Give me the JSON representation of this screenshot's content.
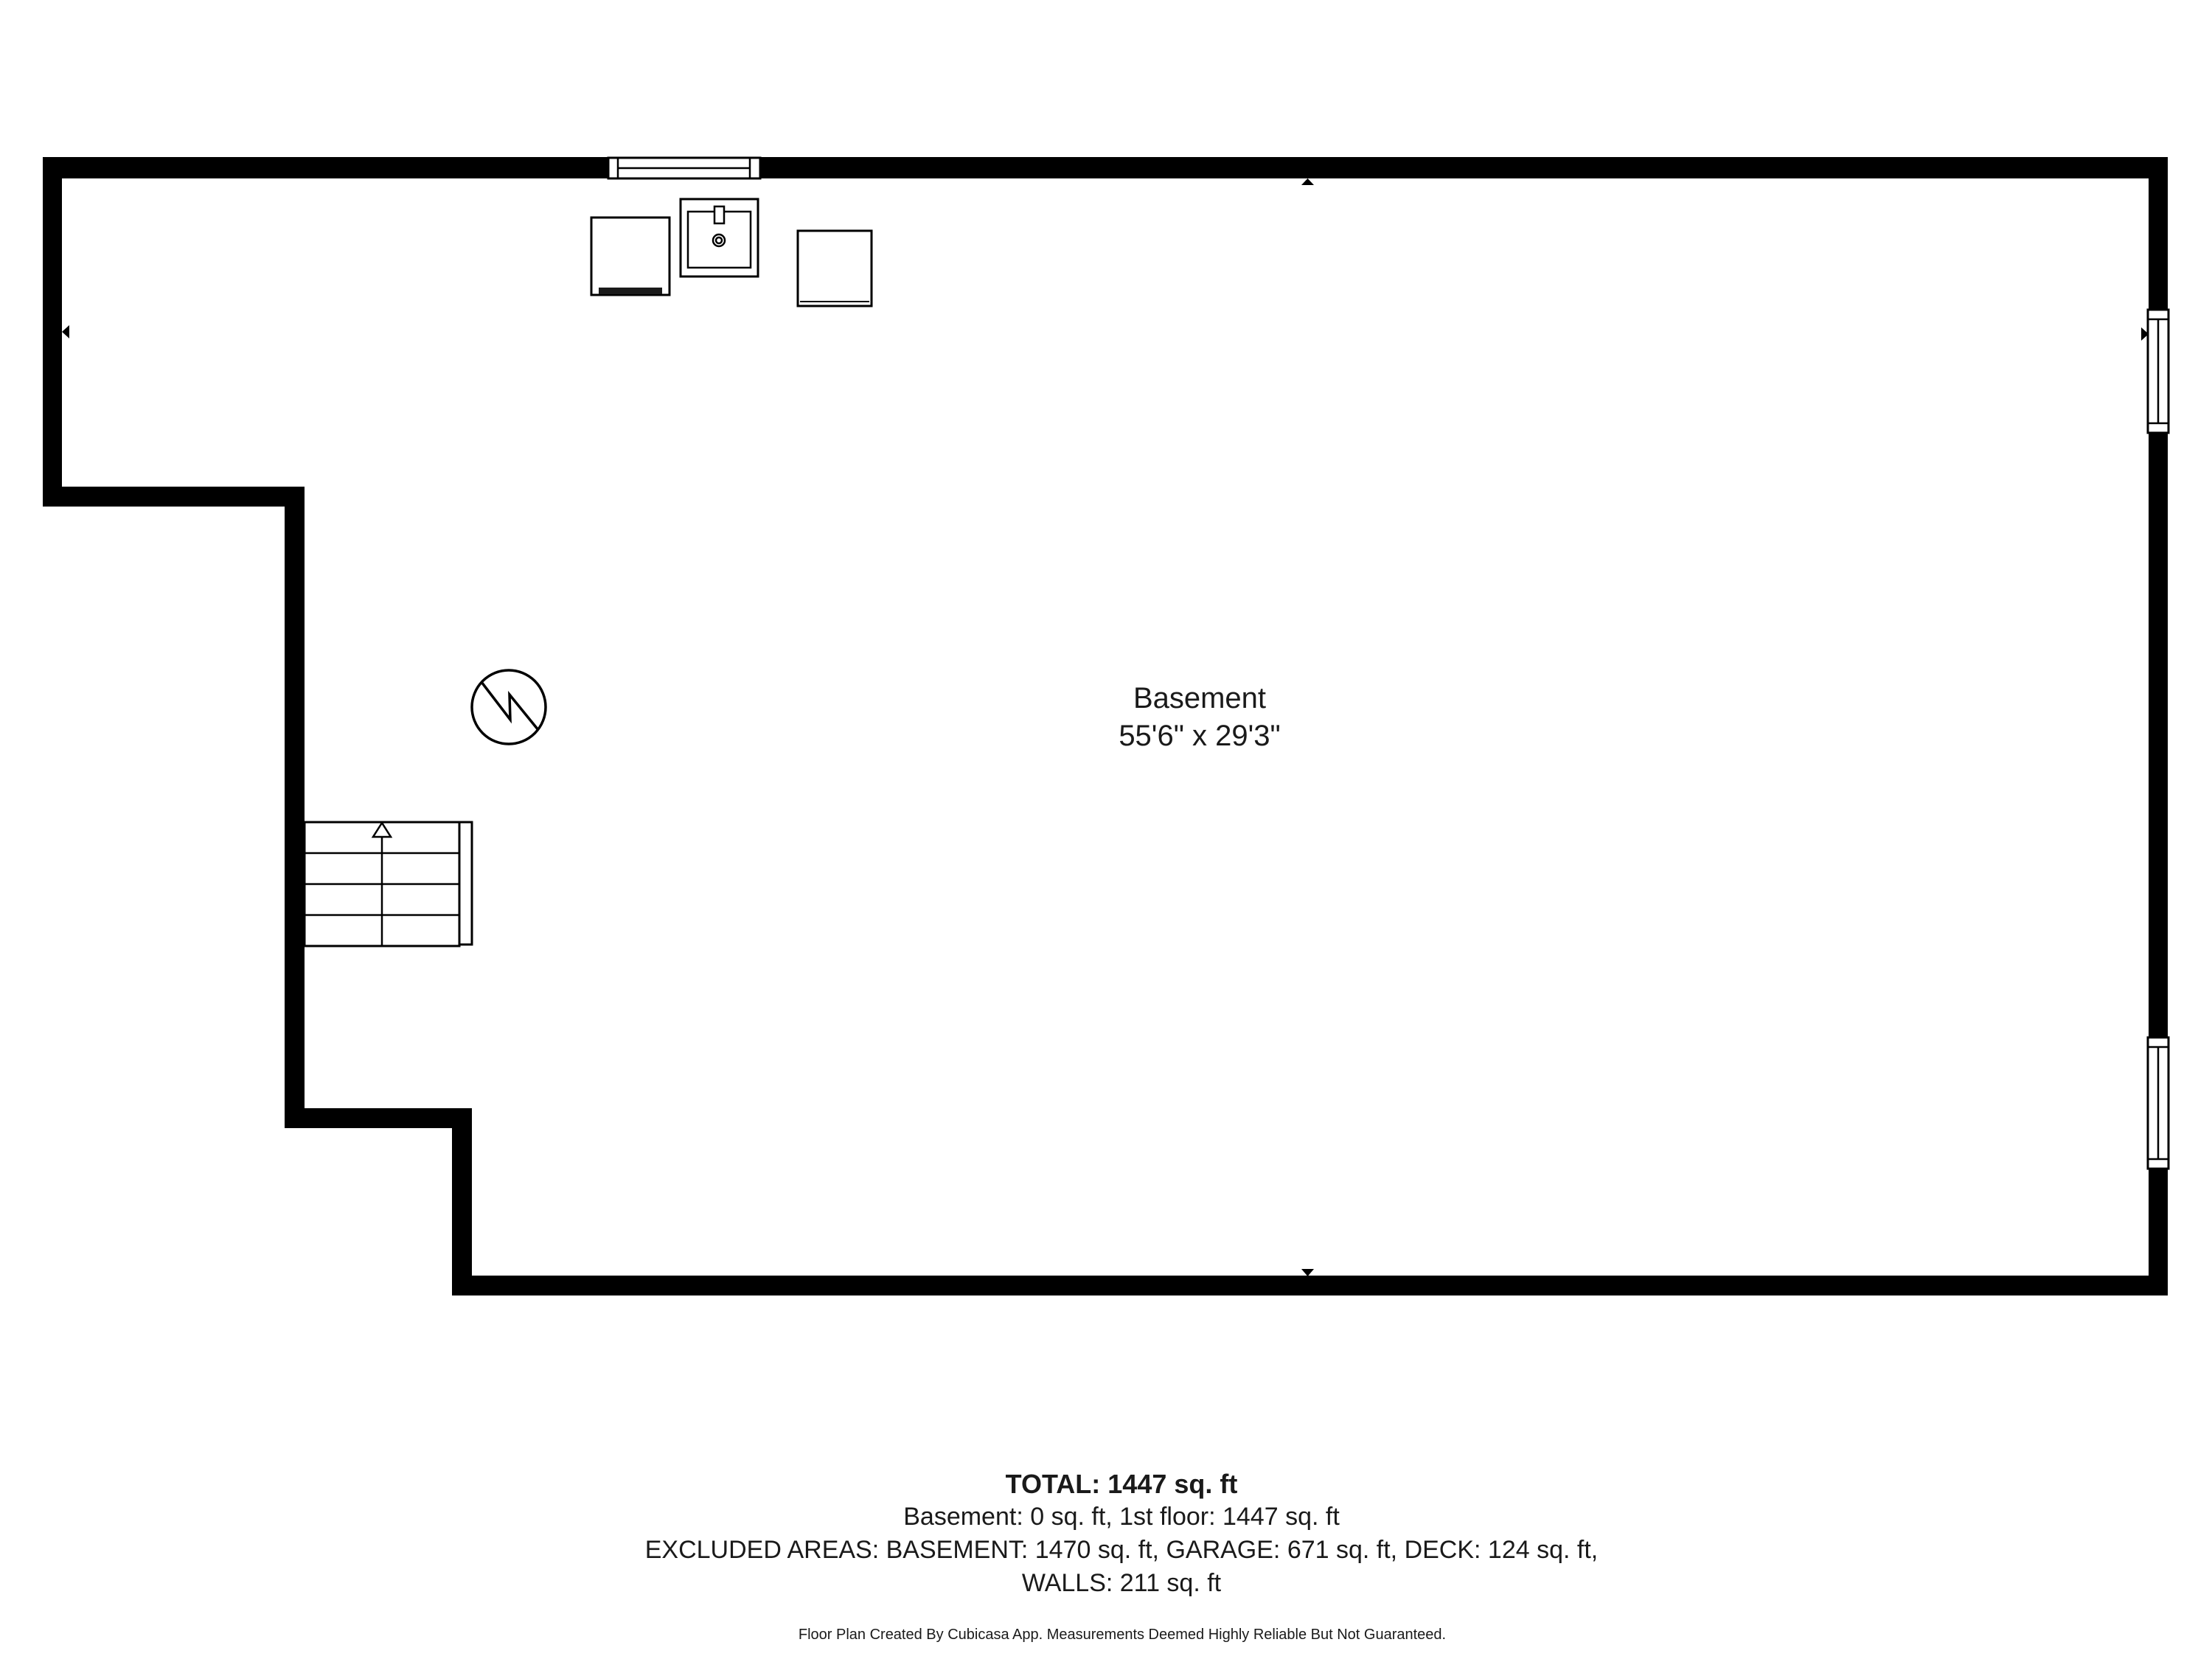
{
  "room": {
    "name": "Basement",
    "dimensions": "55'6\" x 29'3\""
  },
  "summary": {
    "total": "TOTAL: 1447 sq. ft",
    "floors": "Basement: 0 sq. ft, 1st floor: 1447 sq. ft",
    "excluded_line1": "EXCLUDED AREAS: BASEMENT: 1470 sq. ft, GARAGE: 671 sq. ft, DECK: 124 sq. ft,",
    "excluded_line2": "WALLS: 211 sq. ft",
    "disclaimer": "Floor Plan Created By Cubicasa App. Measurements Deemed Highly Reliable But Not Guaranteed."
  },
  "icons": {
    "staircase": "staircase-icon",
    "water_heater": "water-heater-icon",
    "washer": "washer-icon",
    "laundry_sink": "laundry-sink-icon",
    "dryer": "dryer-icon",
    "windows": "window-icon",
    "alignment_arrows": "alignment-arrow-icon"
  },
  "colors": {
    "wall": "#000000",
    "line": "#000000",
    "text": "#1a1a1a",
    "background": "#ffffff"
  }
}
